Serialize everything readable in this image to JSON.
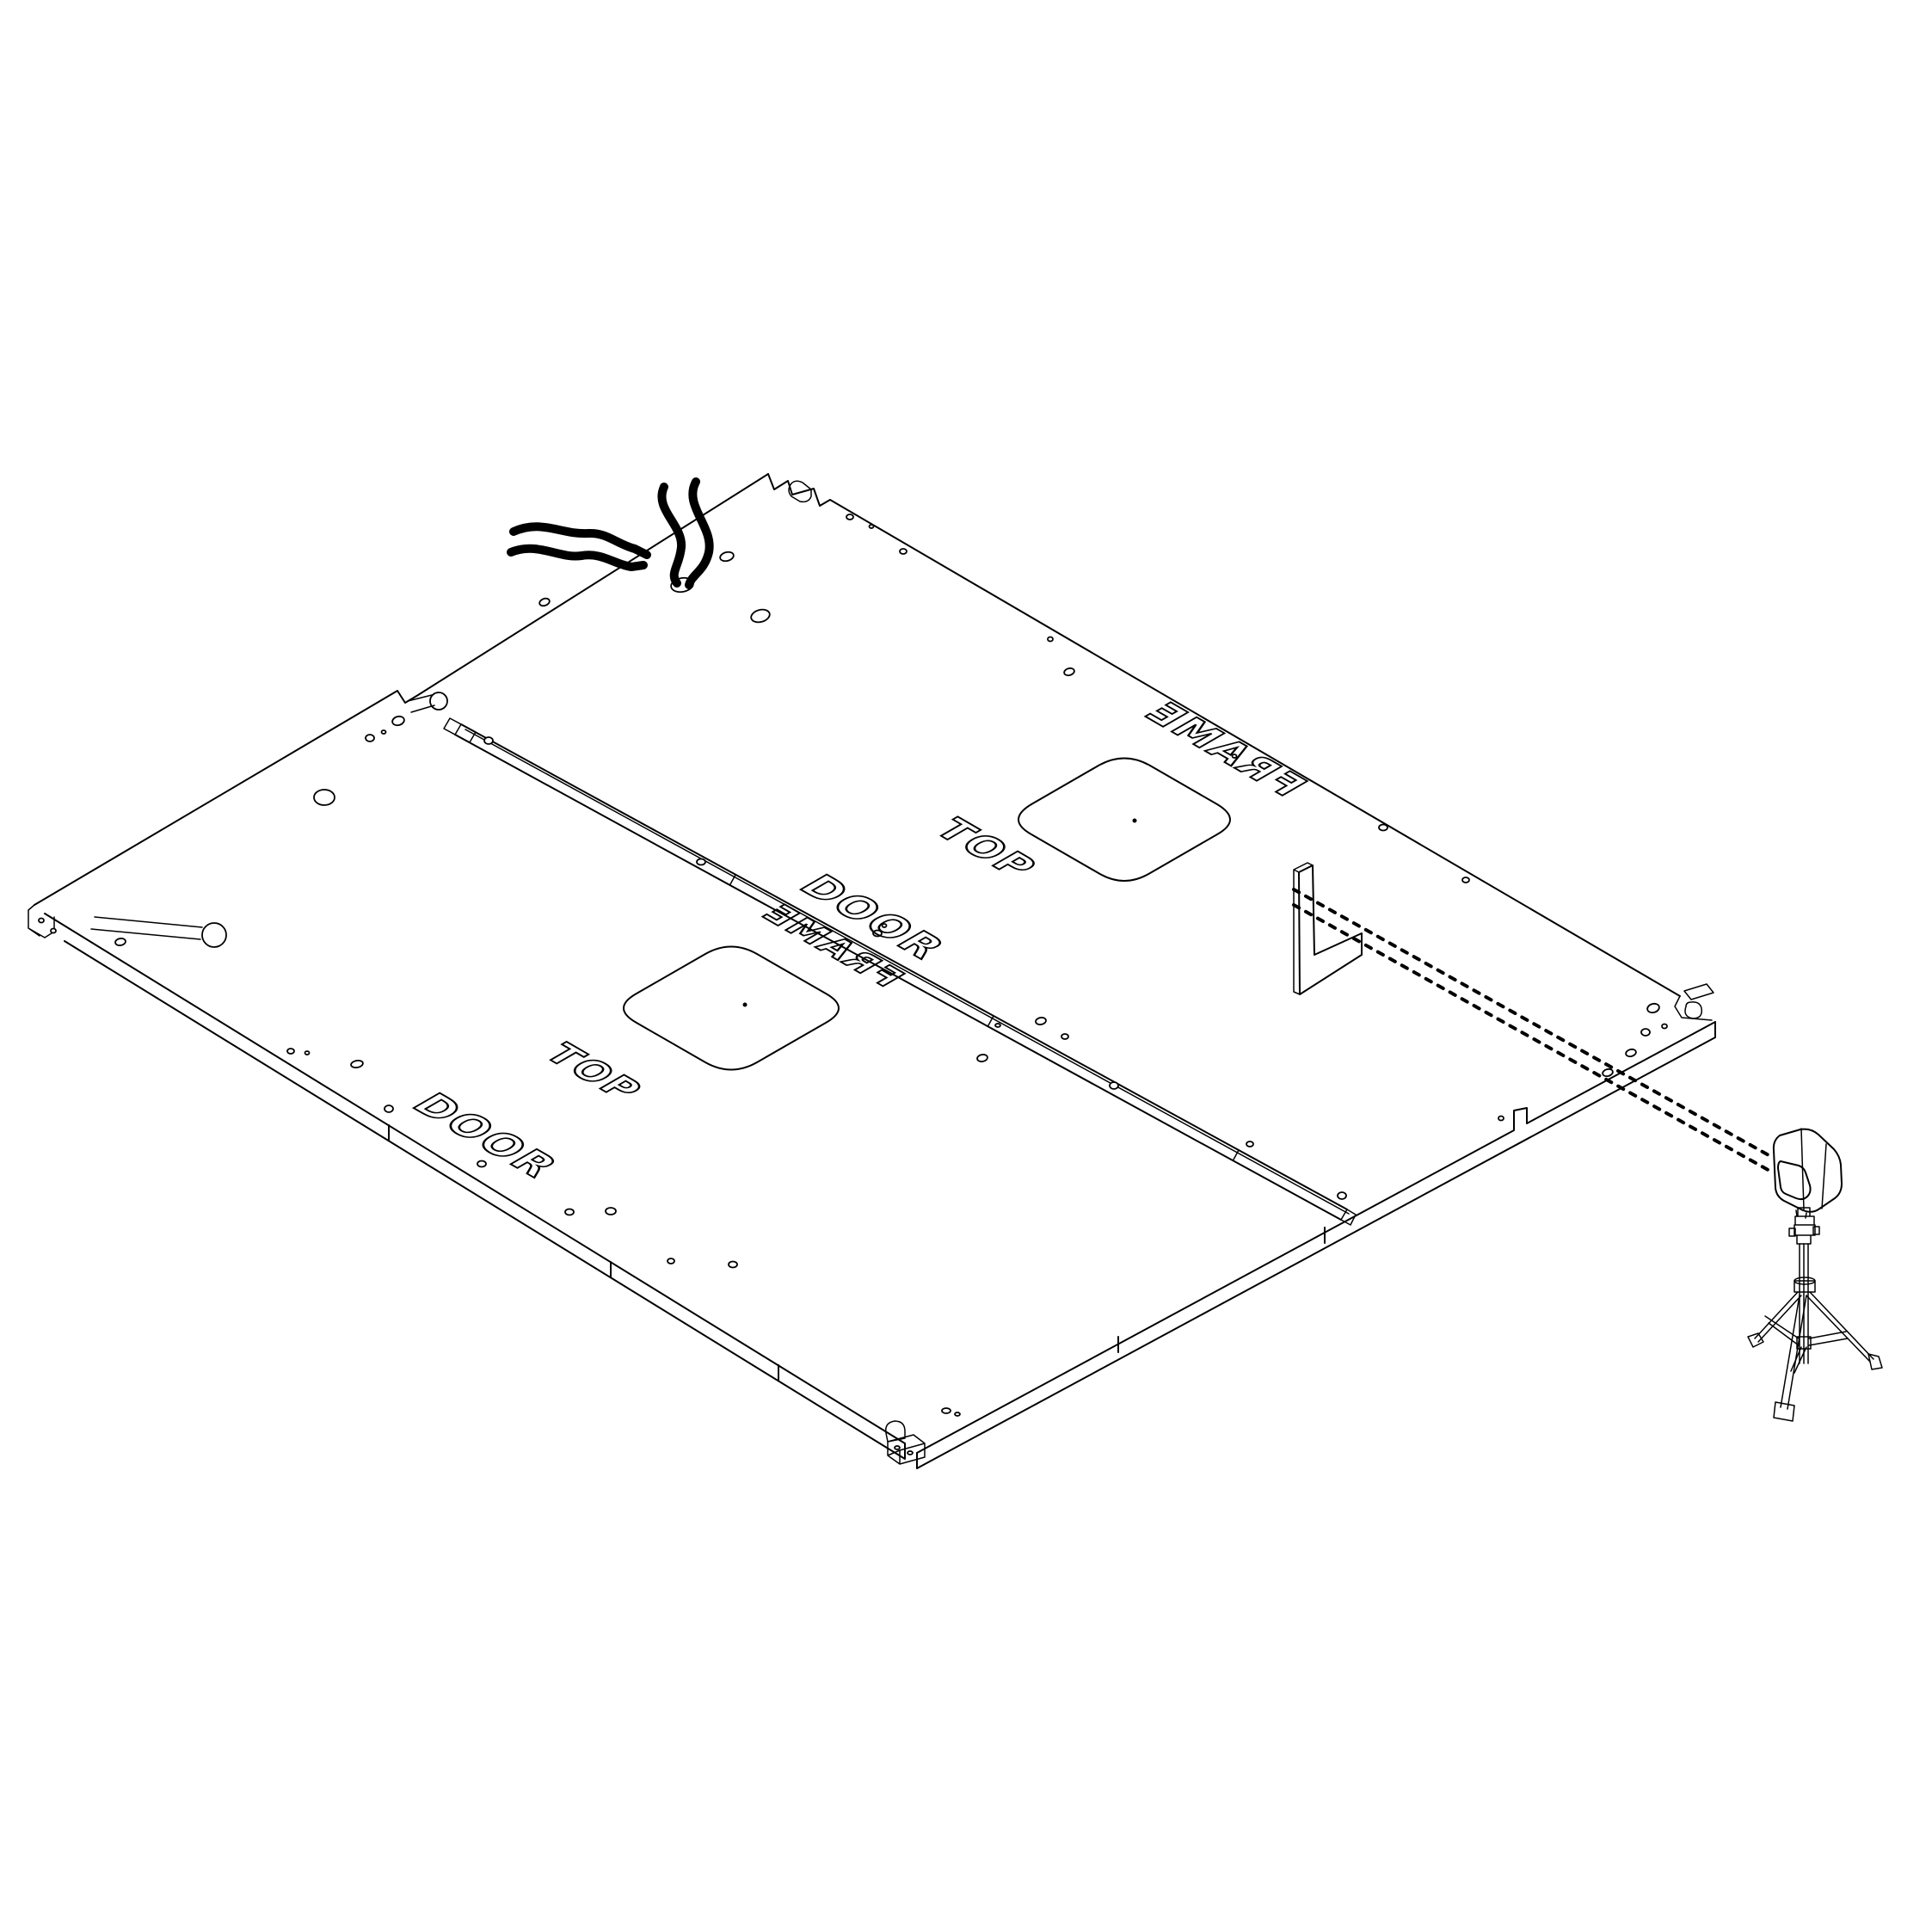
{
  "document": {
    "kind": "isometric-cad-assembly-drawing",
    "background_color": "#ffffff",
    "line_color": "#000000",
    "beam_style": "dashed"
  },
  "labels": {
    "upper_panel": {
      "door": "DOOR",
      "top": "TOP",
      "frame": "FRAME"
    },
    "lower_panel": {
      "door": "DOOR",
      "top": "TOP",
      "frame": "FRAME"
    }
  },
  "parts": {
    "panel_sheet": "flat panel layout with DOOR / FRAME engravings",
    "seam_rail": "center routed channel between panels",
    "cutouts": "rounded square openings with center mark",
    "wires": "loose wire bundles through panel hole",
    "bracket": "L-shaped alignment target",
    "laser": "laser level head on tripod projecting dashed beams"
  }
}
